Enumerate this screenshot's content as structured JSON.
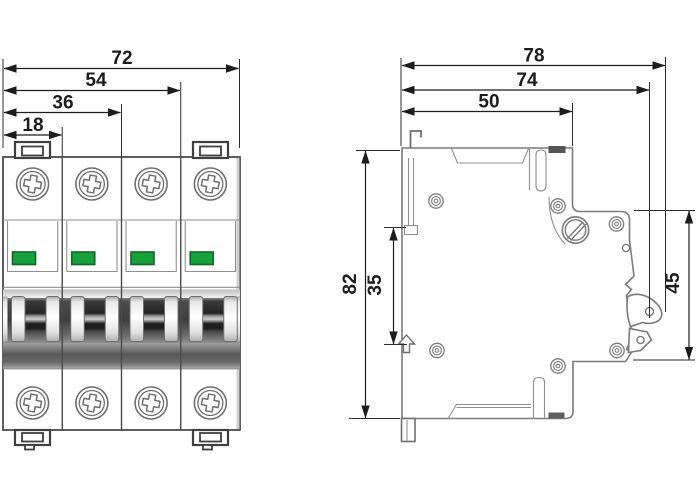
{
  "front_view": {
    "name": "4-pole circuit breaker front view",
    "poles": 4,
    "dim_labels": {
      "overall_width": "72",
      "three_pole_width": "54",
      "two_pole_width": "36",
      "one_pole_width": "18"
    }
  },
  "side_view": {
    "name": "circuit breaker side view",
    "dim_labels": {
      "overall_depth": "78",
      "depth_to_handle": "74",
      "body_depth": "50",
      "overall_height": "82",
      "din_slot_height": "35",
      "front_face_height": "45"
    }
  },
  "colors": {
    "indicator_green": "#17a03b",
    "indicator_green_border": "#0c6a24",
    "outline_gray": "#7b7b7b",
    "dimension_black": "#1c1c1c"
  }
}
